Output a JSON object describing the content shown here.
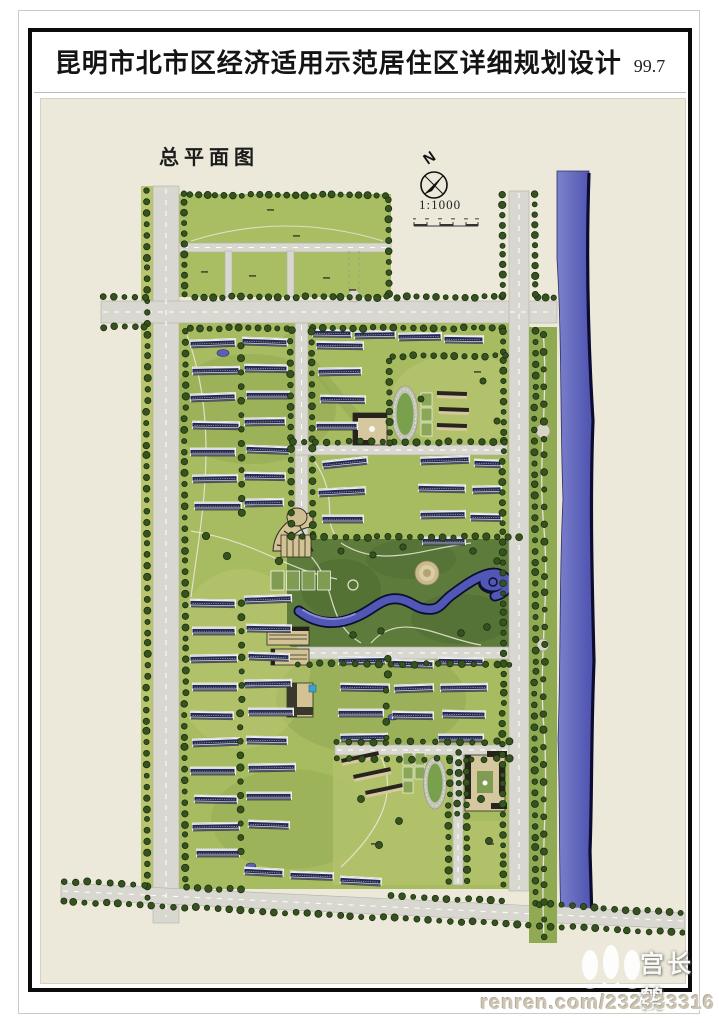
{
  "header": {
    "title": "昆明市北市区经济适用示范居住区详细规划设计",
    "edition": "99.7"
  },
  "map": {
    "plan_label": "总平面图",
    "north_letter": "N",
    "scale_text": "1:1000"
  },
  "watermark": {
    "author": "宫长鹤",
    "url_text": "renren.com/232333316"
  },
  "colors": {
    "paper": "#ffffff",
    "map_background": "#ece9da",
    "parcel_green": "#a9bd62",
    "park_green": "#5d7b3b",
    "tree_green": "#35521f",
    "road_gray": "#d8d8d0",
    "river_blue": "#5157b4",
    "river_edge": "#0c0c30",
    "building_navy": "#242b50",
    "public_building_tan": "#d2c294",
    "frame_black": "#0b0b0b"
  }
}
